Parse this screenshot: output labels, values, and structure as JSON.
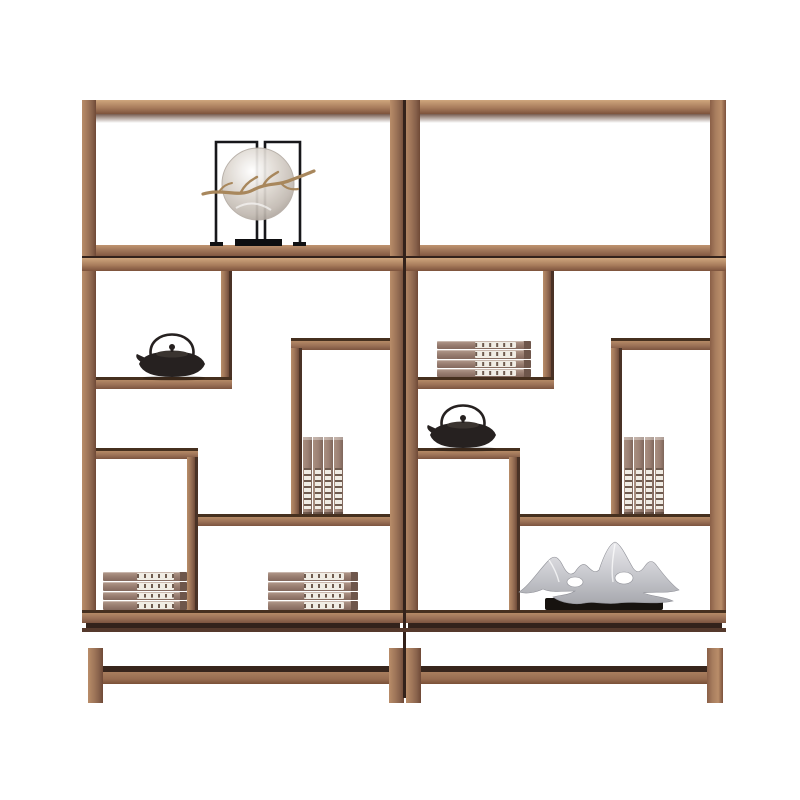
{
  "scene": {
    "type": "product-photo",
    "subject": "Two-bay Chinese-style solid wood display shelf (bogu antique shelf) on a white studio background",
    "background": "#ffffff"
  },
  "colors": {
    "bg": "#ffffff",
    "wood_hi": "#c09470",
    "wood_mid": "#9c7257",
    "wood_lo": "#6f4936",
    "shelf_edge": "#46301f",
    "seam": "#33221b",
    "metal_black": "#262120",
    "glass_gray": "#cfc9c2",
    "branch_gold": "#a8875c",
    "book_cover": "#9b8073",
    "book_label": "#f0ece4",
    "book_text": "#6f5b4f",
    "silver_light": "#e9e9ec",
    "silver_dark": "#a7a8ae",
    "base_black": "#17130f"
  },
  "furniture": {
    "name": "two-bay wooden display shelf",
    "sections": [
      "open top frames",
      "asymmetric lattice display shelves",
      "base with stretcher and legs"
    ]
  },
  "items": {
    "orb": {
      "name": "glass orb ornament with gold branch in black metal stand",
      "location": "top left bay"
    },
    "teapot_left": {
      "name": "black cast-iron teapot",
      "location": "left bay, upper-left shelf"
    },
    "teapot_right": {
      "name": "black cast-iron teapot",
      "location": "right bay, middle-left shelf"
    },
    "flat_books_left": {
      "name": "stack of four books",
      "location": "left bay, bottom-left"
    },
    "flat_books_mid": {
      "name": "stack of four books",
      "location": "left bay, bottom-center"
    },
    "flat_books_right_bay": {
      "name": "stack of four books",
      "location": "right bay, upper-left shelf"
    },
    "standing_books_left": {
      "name": "four standing book volumes",
      "location": "left bay, center shelf"
    },
    "standing_books_right": {
      "name": "four standing book volumes",
      "location": "right bay, center shelf"
    },
    "sculpture": {
      "name": "silver abstract mountain sculpture on black base",
      "location": "right bay, bottom shelf"
    }
  }
}
